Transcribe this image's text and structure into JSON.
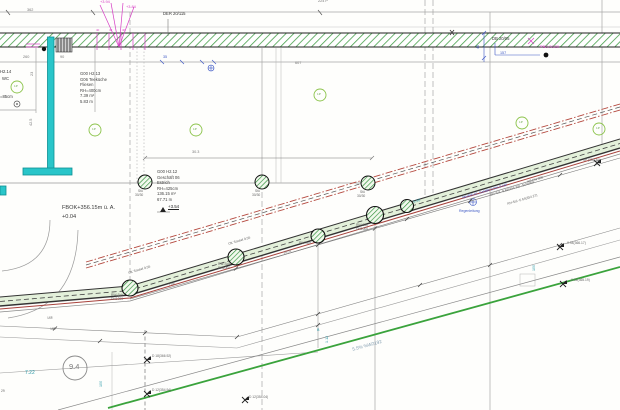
{
  "drawing": {
    "type": "site-utility-plan",
    "elevation_note": "FBOK+356.15m ü. A.",
    "elevation_offset": "+0.04"
  },
  "colors": {
    "cyan_wall": "#29c5c9",
    "insulation_hatch_green": "#46a04b",
    "corridor_fill": "#e3f0da",
    "terrain_green": "#3aa33c",
    "pipe_red": "#b5493f",
    "annotation_magenta": "#d63ec4",
    "dimension_blue": "#3b56c4",
    "dimension_teal": "#2a9aa8"
  },
  "symbols": {
    "manhole": "green-hatched-circle",
    "column": "green-hatched-circle-small",
    "tree_marker": "light-green-circle",
    "survey_point": "black-x-flag",
    "rain_pipe_marker": "blue-crossed-circle",
    "door_swing": "gray-arc"
  },
  "labels": [
    {
      "t": "362",
      "x": 27,
      "y": 9,
      "c": "g",
      "n": "dim-362"
    },
    {
      "t": "224 P",
      "x": 318,
      "y": 0,
      "c": "g",
      "n": "dim-224p"
    },
    {
      "t": "DER 20/115",
      "x": 163,
      "y": 12,
      "c": "k",
      "n": "beam-tag"
    },
    {
      "t": "+3.94",
      "x": 100,
      "y": 0,
      "c": "m"
    },
    {
      "t": "+3.84",
      "x": 126,
      "y": 5,
      "c": "m"
    },
    {
      "t": "40",
      "x": 96,
      "y": 29,
      "c": "m2"
    },
    {
      "t": "40",
      "x": 109,
      "y": 29,
      "c": "m2"
    },
    {
      "t": "40",
      "x": 122,
      "y": 29,
      "c": "m2"
    },
    {
      "t": "DB 20/05",
      "x": 492,
      "y": 37,
      "c": "k",
      "n": "beam-tag"
    },
    {
      "t": "PBO 20/20",
      "x": 540,
      "y": 45,
      "c": "m",
      "n": "column-tag"
    },
    {
      "t": "157",
      "x": 500,
      "y": 52,
      "c": "b"
    },
    {
      "t": "45",
      "x": 477,
      "y": 49,
      "c": "b",
      "r": -90
    },
    {
      "t": "35",
      "x": 163,
      "y": 56,
      "c": "b"
    },
    {
      "t": "90",
      "x": 60,
      "y": 56,
      "c": "g"
    },
    {
      "t": "260",
      "x": 23,
      "y": 56,
      "c": "g"
    },
    {
      "t": "607",
      "x": 295,
      "y": 62,
      "c": "g"
    },
    {
      "t": "23",
      "x": 31,
      "y": 76,
      "c": "g",
      "r": -90
    },
    {
      "t": "H2.14",
      "x": 0,
      "y": 70,
      "c": "k"
    },
    {
      "t": "WC",
      "x": 2,
      "y": 77,
      "c": "k"
    },
    {
      "t": "=85cm",
      "x": 0,
      "y": 95,
      "c": "k"
    },
    {
      "t": "42.5",
      "x": 30,
      "y": 126,
      "c": "g",
      "r": -90
    },
    {
      "t": "G00 H2.13",
      "x": 80,
      "y": 72,
      "c": "k4",
      "n": "room-id"
    },
    {
      "t": "G06 Teeküche",
      "x": 80,
      "y": 77.5,
      "c": "k4",
      "n": "room-name"
    },
    {
      "t": "Fliesen",
      "x": 80,
      "y": 83,
      "c": "k4"
    },
    {
      "t": "RH=400cm",
      "x": 80,
      "y": 88.5,
      "c": "k4"
    },
    {
      "t": "7.39 m²",
      "x": 80,
      "y": 94,
      "c": "k4"
    },
    {
      "t": "5.83 m",
      "x": 80,
      "y": 99.5,
      "c": "k4"
    },
    {
      "t": "30.3",
      "x": 192,
      "y": 151,
      "c": "g"
    },
    {
      "t": "G00 H2.12",
      "x": 157,
      "y": 170,
      "c": "k4",
      "n": "room-id"
    },
    {
      "t": "Geschäft 06",
      "x": 157,
      "y": 175.5,
      "c": "k4",
      "n": "room-name"
    },
    {
      "t": "Estrich",
      "x": 157,
      "y": 181,
      "c": "k4"
    },
    {
      "t": "RH=425cm",
      "x": 157,
      "y": 186.5,
      "c": "k4"
    },
    {
      "t": "136.15 m²",
      "x": 157,
      "y": 192,
      "c": "k4"
    },
    {
      "t": "67.71 m",
      "x": 157,
      "y": 197.5,
      "c": "k4"
    },
    {
      "t": "+3.54",
      "x": 168,
      "y": 205,
      "c": "k4u",
      "n": "spot-elevation"
    },
    {
      "t": "FBOK+356.15m ü. A.",
      "x": 62,
      "y": 206,
      "c": "f",
      "n": "floor-elevation-note"
    },
    {
      "t": "+0.04",
      "x": 62,
      "y": 215,
      "c": "f"
    },
    {
      "t": "Stü",
      "x": 138,
      "y": 190,
      "c": "g3"
    },
    {
      "t": "30/30",
      "x": 135,
      "y": 194,
      "c": "g3"
    },
    {
      "t": "Stü",
      "x": 255,
      "y": 190,
      "c": "g3"
    },
    {
      "t": "30/30",
      "x": 252,
      "y": 194,
      "c": "g3"
    },
    {
      "t": "Stü",
      "x": 360,
      "y": 191,
      "c": "g3"
    },
    {
      "t": "30/30",
      "x": 357,
      "y": 195,
      "c": "g3"
    },
    {
      "t": "RW-Sch",
      "x": 111,
      "y": 294,
      "c": "g3",
      "n": "manhole-label"
    },
    {
      "t": "DN1000",
      "x": 111,
      "y": 298,
      "c": "g3"
    },
    {
      "t": "RW-Sch",
      "x": 218,
      "y": 263,
      "c": "g3",
      "n": "manhole-label"
    },
    {
      "t": "DN1000",
      "x": 218,
      "y": 267,
      "c": "g3"
    },
    {
      "t": "RW-Sch",
      "x": 299,
      "y": 242,
      "c": "g3",
      "n": "manhole-label"
    },
    {
      "t": "RW-Sch",
      "x": 356,
      "y": 224,
      "c": "g3",
      "n": "manhole-label"
    },
    {
      "t": "DN1000",
      "x": 356,
      "y": 228,
      "c": "g3"
    },
    {
      "t": "OK Sockel 9.56",
      "x": 128,
      "y": 272,
      "c": "g3",
      "r": -16.5
    },
    {
      "t": "OK Sockel 9.56",
      "x": 228,
      "y": 243,
      "c": "g3",
      "r": -16.5
    },
    {
      "t": "7.08",
      "x": 168,
      "y": 284,
      "c": "g3",
      "r": -16.5
    },
    {
      "t": "10.01",
      "x": 283,
      "y": 252,
      "c": "g3",
      "r": -16.5
    },
    {
      "t": "5.58",
      "x": 413,
      "y": 201,
      "c": "t",
      "r": -16.5
    },
    {
      "t": "KS DN 300",
      "x": 527,
      "y": 181,
      "c": "g3",
      "r": -16.5,
      "n": "pipe-label"
    },
    {
      "t": "BH-Sol -9.83(355.28) -Schieber",
      "x": 490,
      "y": 194,
      "c": "g3",
      "r": -16.5
    },
    {
      "t": "RH-Sol -5.64(354.27)",
      "x": 507,
      "y": 203,
      "c": "g3",
      "r": -16.5
    },
    {
      "t": "RW/PE-KL Gefälle 2.0% 0-HP",
      "x": 462,
      "y": 197,
      "c": "b3",
      "r": -16.5,
      "n": "rain-pipe-label"
    },
    {
      "t": "Regenleitung",
      "x": 459,
      "y": 210,
      "c": "b3"
    },
    {
      "t": "4P (355.30)",
      "x": 583,
      "y": 159,
      "c": "g3",
      "n": "survey-label"
    },
    {
      "t": "9.4",
      "x": 69,
      "y": 363,
      "c": "big",
      "n": "parcel-number"
    },
    {
      "t": "7.22",
      "x": 25,
      "y": 371,
      "c": "t5"
    },
    {
      "t": "100",
      "x": 100,
      "y": 387,
      "c": "t",
      "r": -90
    },
    {
      "t": "168",
      "x": 47,
      "y": 317,
      "c": "g3",
      "r": -4
    },
    {
      "t": "188",
      "x": 50,
      "y": 328,
      "c": "g3",
      "r": -4
    },
    {
      "t": "D 18(366.92)",
      "x": 152,
      "y": 355,
      "c": "g3",
      "n": "survey-label"
    },
    {
      "t": "D 12(354.94)",
      "x": 152,
      "y": 389,
      "c": "g3",
      "n": "survey-label"
    },
    {
      "t": "D 12(354.04)",
      "x": 249,
      "y": 396,
      "c": "g3",
      "n": "survey-label"
    },
    {
      "t": "-0.94(366.17)",
      "x": 566,
      "y": 242,
      "c": "g3",
      "n": "survey-label"
    },
    {
      "t": "-0.92(365.19)",
      "x": 570,
      "y": 279,
      "c": "g3",
      "n": "survey-label"
    },
    {
      "t": "100",
      "x": 533,
      "y": 271,
      "c": "t",
      "r": -90
    },
    {
      "t": "B",
      "x": 317,
      "y": 329,
      "c": "t"
    },
    {
      "t": "1.12",
      "x": 326,
      "y": 343,
      "c": "t",
      "r": -90
    },
    {
      "t": "5.5% %W2192",
      "x": 352,
      "y": 348,
      "c": "gb",
      "r": -15.5,
      "n": "slope-label"
    },
    {
      "t": "29",
      "x": 1,
      "y": 390,
      "c": "g3"
    },
    {
      "t": "1P",
      "x": 14,
      "y": 85,
      "c": "gr"
    },
    {
      "t": "1P",
      "x": 92,
      "y": 128,
      "c": "gr"
    },
    {
      "t": "1P",
      "x": 193,
      "y": 128,
      "c": "gr"
    },
    {
      "t": "1P",
      "x": 317,
      "y": 93,
      "c": "gr"
    },
    {
      "t": "1P",
      "x": 519,
      "y": 121,
      "c": "gr"
    },
    {
      "t": "1P",
      "x": 596,
      "y": 127,
      "c": "gr"
    }
  ]
}
